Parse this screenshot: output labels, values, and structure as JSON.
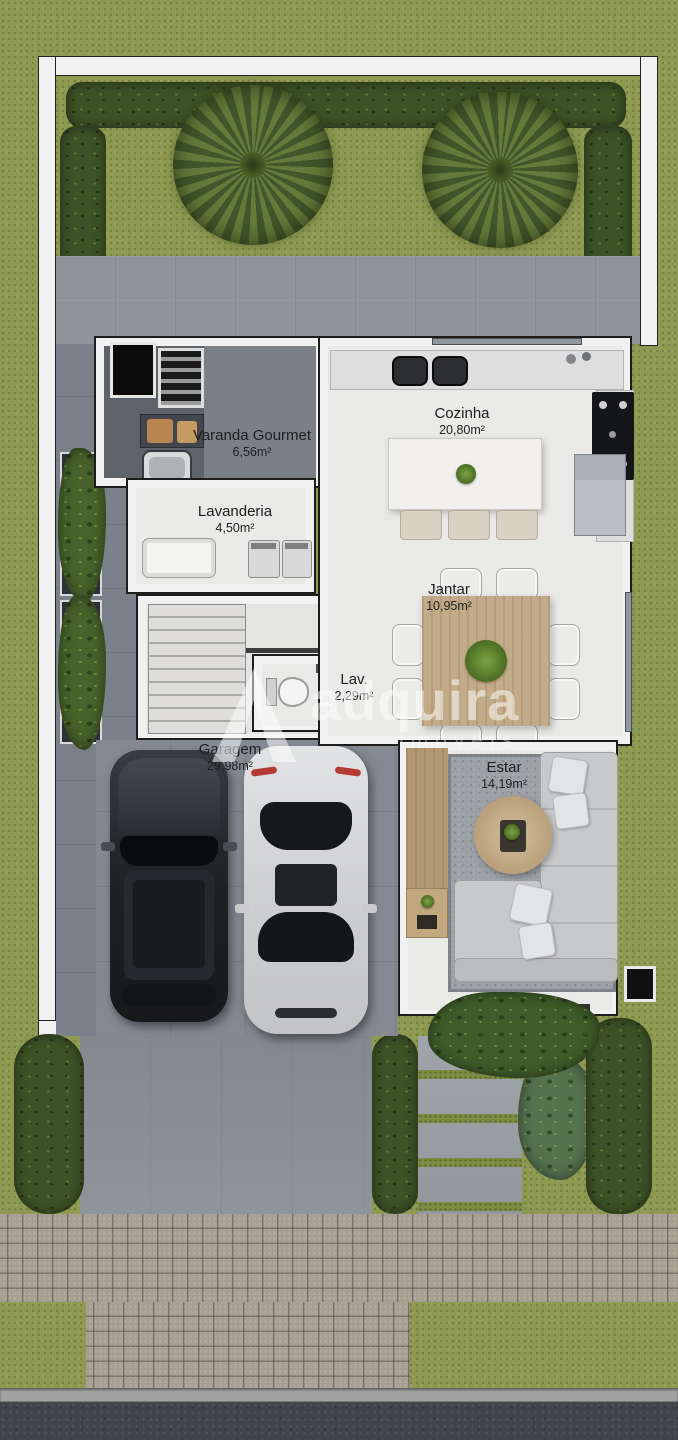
{
  "watermark": {
    "brand": "adquira",
    "tagline": "imóveis",
    "logo": "triangle-a-logo"
  },
  "rooms": [
    {
      "id": "varanda-gourmet",
      "name": "Varanda Gourmet",
      "area": "6,56m²"
    },
    {
      "id": "cozinha",
      "name": "Cozinha",
      "area": "20,80m²"
    },
    {
      "id": "lavanderia",
      "name": "Lavanderia",
      "area": "4,50m²"
    },
    {
      "id": "jantar",
      "name": "Jantar",
      "area": "10,95m²"
    },
    {
      "id": "lavabo",
      "name": "Lav.",
      "area": "2,29m²"
    },
    {
      "id": "garagem",
      "name": "Garagem",
      "area": "29,98m²"
    },
    {
      "id": "estar",
      "name": "Estar",
      "area": "14,19m²"
    }
  ],
  "colors": {
    "grass": "#8e9a52",
    "hedge": "#3d5226",
    "patio": "#8f949b",
    "corridor": "#7b818a",
    "floor": "#e9e9e7",
    "wallfill": "#f0f1f0",
    "wood": "#c2ab88",
    "rug": "#9ba0a5",
    "paver": "#a89f93",
    "asphalt": "#414449",
    "garage": "#858a92",
    "driveway": "#8a9096"
  }
}
